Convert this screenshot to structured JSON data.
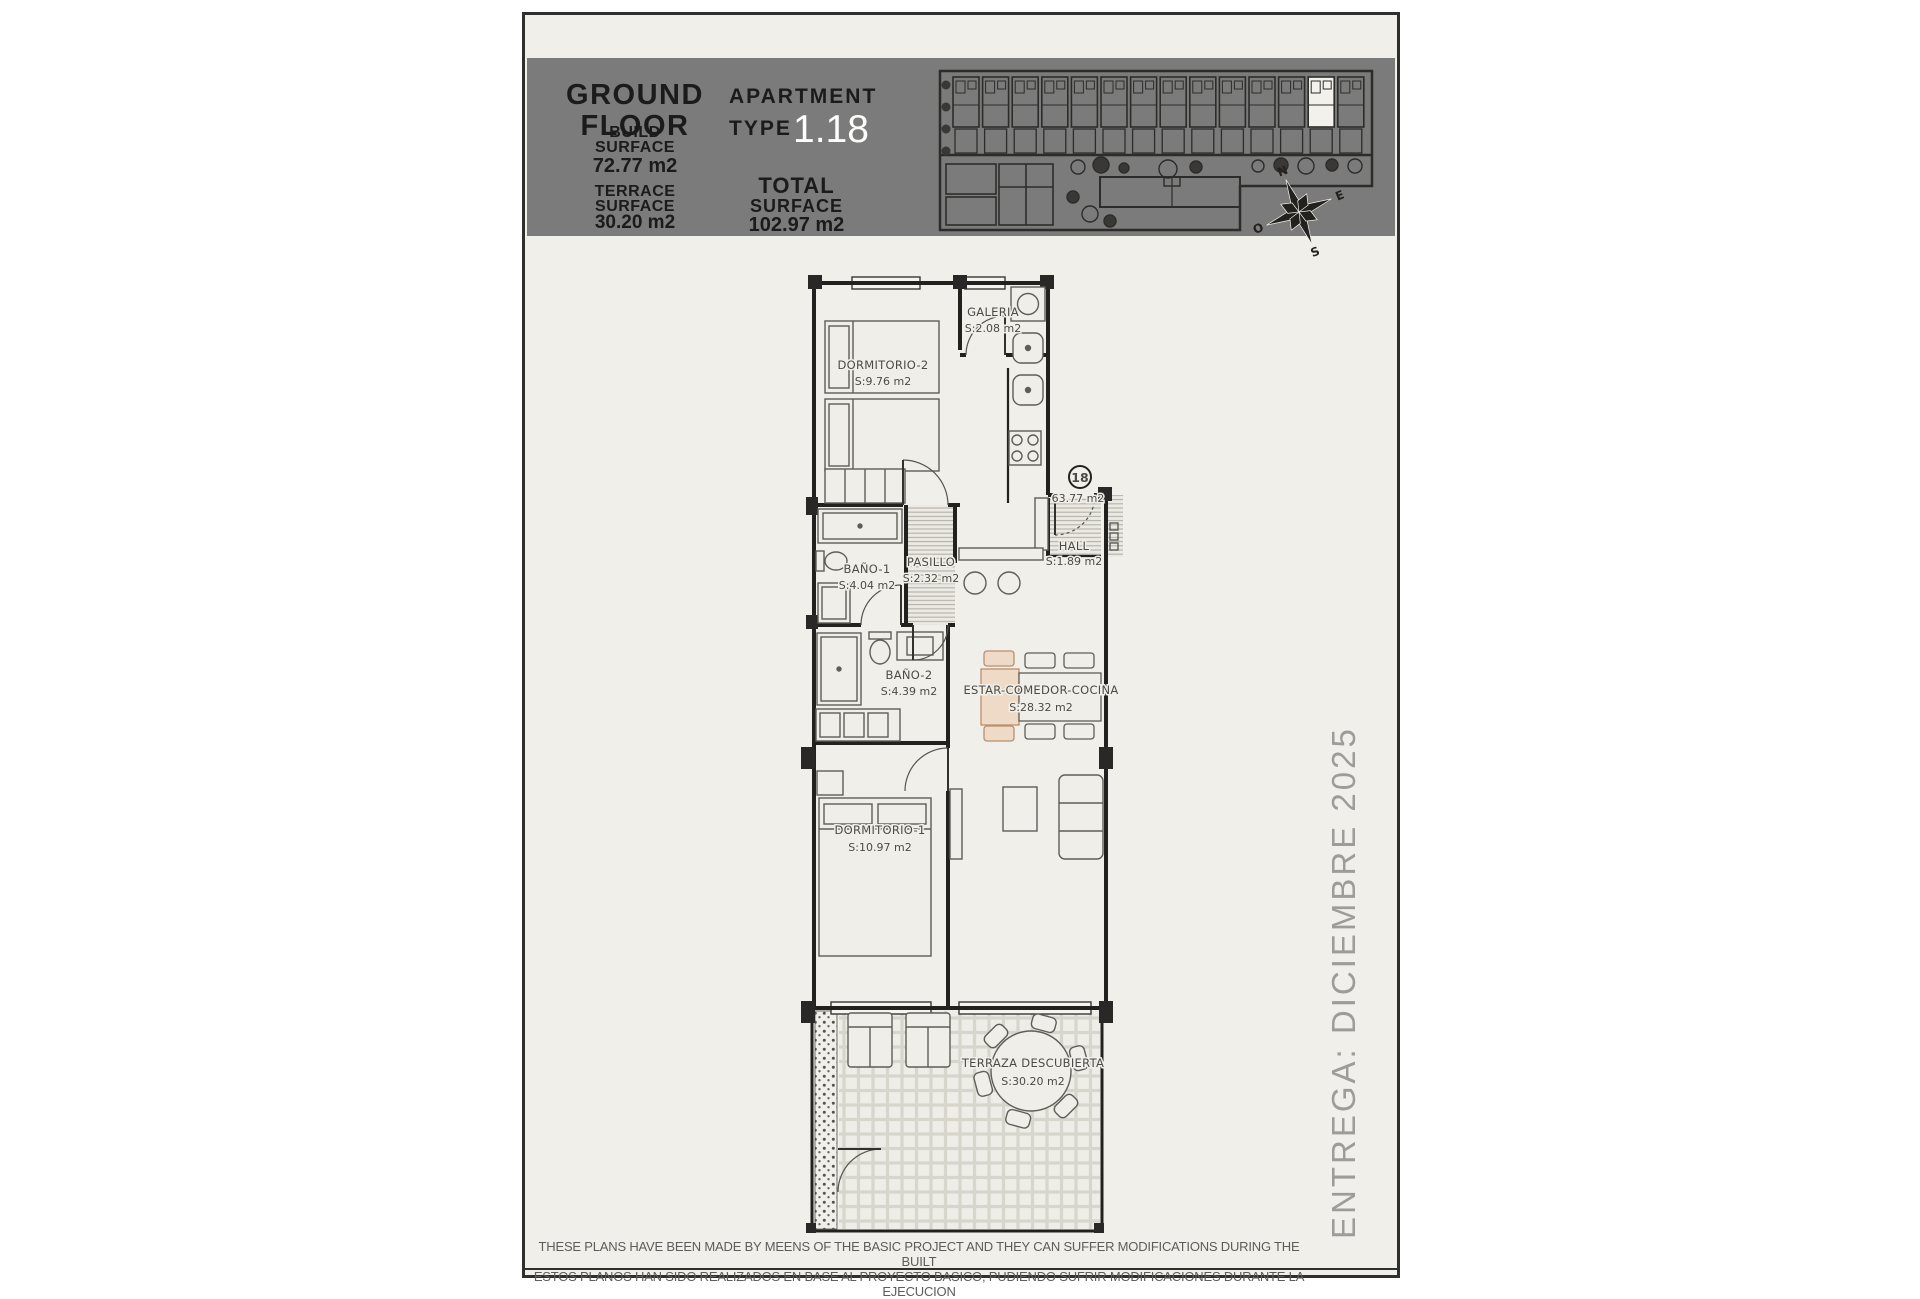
{
  "header": {
    "floor_title": "GROUND FLOOR",
    "floor_title_line1": "GROUND",
    "floor_title_line2": "FLOOR",
    "apartment_label": "APARTMENT",
    "type_label": "TYPE",
    "apartment_type": "1.18",
    "build_surface_label1": "BUILD",
    "build_surface_label2": "SURFACE",
    "build_surface_value": "72.77 m2",
    "terrace_surface_label1": "TERRACE",
    "terrace_surface_label2": "SURFACE",
    "terrace_surface_value": "30.20 m2",
    "total_surface_label1": "TOTAL",
    "total_surface_label2": "SURFACE",
    "total_surface_value": "102.97 m2"
  },
  "rooms": [
    {
      "name": "DORMITORIO-2",
      "area": "S:9.76 m2"
    },
    {
      "name": "GALERIA",
      "area": "S:2.08 m2"
    },
    {
      "name": "BAÑO-1",
      "area": "S:4.04 m2"
    },
    {
      "name": "PASILLO",
      "area": "S:2.32 m2"
    },
    {
      "name": "HALL",
      "area": "S:1.89 m2"
    },
    {
      "name": "BAÑO-2",
      "area": "S:4.39 m2"
    },
    {
      "name": "ESTAR-COMEDOR-COCINA",
      "area": "S:28.32 m2"
    },
    {
      "name": "DORMITORIO-1",
      "area": "S:10.97 m2"
    },
    {
      "name": "TERRAZA DESCUBIERTA",
      "area": "S:30.20 m2"
    }
  ],
  "annotations": {
    "unit_number": "18",
    "useful_area": "63.77 m2"
  },
  "compass": {
    "n": "N",
    "e": "E",
    "s": "S",
    "o": "O"
  },
  "site_plan": {
    "unit_count": 14,
    "highlighted_unit_index": 12
  },
  "delivery_note": "ENTREGA: DICIEMBRE 2025",
  "footer": {
    "line1": "THESE PLANS HAVE BEEN MADE BY MEENS OF THE BASIC PROJECT AND THEY CAN SUFFER MODIFICATIONS DURING THE BUILT",
    "line2": "ESTOS PLANOS HAN SIDO REALIZADOS EN BASE AL PROYECTO BASICO, PUDIENDO SUFRIR MODIFICACIONES DURANTE LA EJECUCION"
  },
  "colors": {
    "page_background": "#f1efe9",
    "header_background": "#7b7b7b",
    "wall": "#23211e",
    "highlight_white": "#f3f1eb",
    "dining_accent_peach": "#eedac6",
    "delivery_text": "#9c9c9a"
  }
}
